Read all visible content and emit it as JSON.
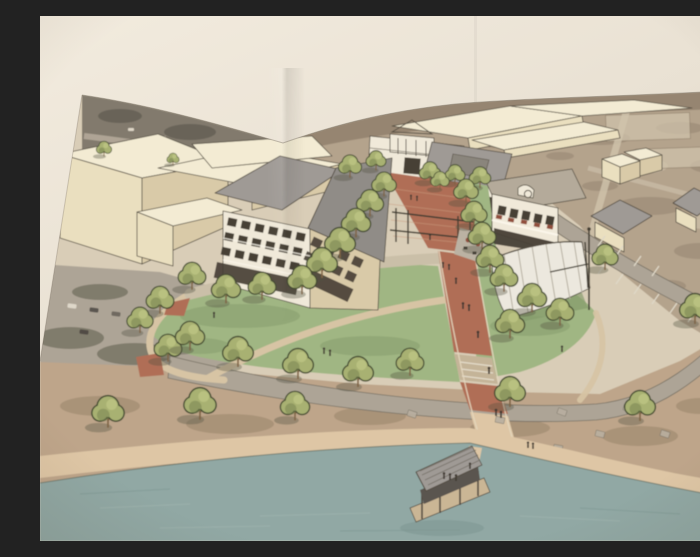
{
  "scene": {
    "type": "photograph-of-printed-architectural-rendering",
    "view": "aerial-perspective",
    "description": "Photograph of a printed aerial architectural rendering of a lakeside town-center park: a red brick promenade lined with trees leads from a commercial street past a four-story mixed-use building and a two-story restaurant to a large lawn with a white band-shell canopy, curving paths, parking areas, scattered small houses, a shoreline walkway and a covered dock on a lake.",
    "visible_text": "none"
  },
  "colors": {
    "photo-bg": "#e9e1d3",
    "photo-bg-light": "#f2ebde",
    "photo-bg-dark": "#dbd0bd",
    "paper": "#d8ccb5",
    "ink": "#4d463a",
    "terrain": "#b2a089",
    "terrain-dark": "#8b7b66",
    "terrain-light": "#cec0a8",
    "asphalt": "#aba293",
    "asphalt-dark": "#746d60",
    "cream-top": "#f3ebd2",
    "cream-front": "#eadebd",
    "cream-side": "#d8c9a6",
    "roof-grey": "#8d8984",
    "roof-grey2": "#9c9792",
    "roof-tan": "#b2a897",
    "white-wall": "#f0e9d8",
    "window": "#41392f",
    "grass": "#9db47f",
    "grass-dark": "#7f9765",
    "tree": "#a6af6e",
    "tree-light": "#c0c784",
    "tree-dark": "#6f7c48",
    "tree-outline": "#3f472c",
    "trunk": "#7b5f3e",
    "brick": "#ae6a51",
    "brick-light": "#c9a379",
    "path": "#d6c3a2",
    "sidewalk": "#c9bda6",
    "dirt": "#bca387",
    "dirt-dark": "#947e62",
    "sand": "#ddc5a3",
    "water": "#8ea6a2",
    "water-dark": "#7b948f",
    "water-light": "#a3b6b0",
    "canopy": "#ece8dd",
    "canopy-line": "#b3ac9d",
    "red-accent": "#8e4a38",
    "people": "#3a332b",
    "shadow": "#4e4d3e"
  }
}
